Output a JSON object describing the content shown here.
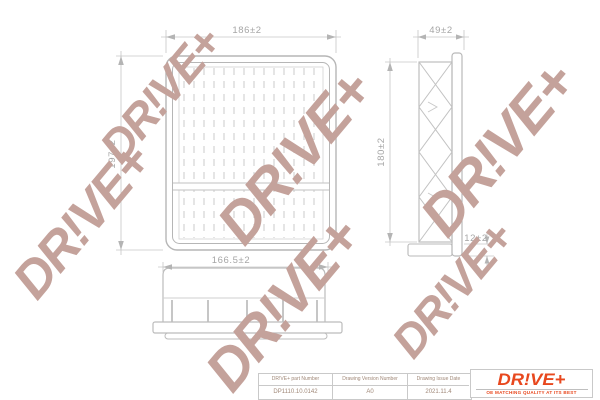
{
  "watermark": {
    "text": "DR!VE+"
  },
  "colors": {
    "accent": "#e8481e",
    "watermark": "#c4a29b",
    "drawing_line": "#b6b6b6",
    "dim_text": "#a6a6a6"
  },
  "views": {
    "top": {
      "width_dim": "186±2",
      "height_dim": "197±2"
    },
    "side": {
      "width_dim": "49±2",
      "height_dim": "180±2",
      "lip_dim": "12±2"
    },
    "front": {
      "width_dim": "166.5±2"
    }
  },
  "title_block": {
    "part_number_label": "DR!VE+ part Number",
    "part_number_value": "DP1110.10.0142",
    "version_label": "Drawing Version Number",
    "version_value": "A0",
    "date_label": "Drawing Issue Date",
    "date_value": "2021.11.4"
  },
  "logo": {
    "wordmark": "DR!VE+",
    "tagline": "OE MATCHING QUALITY AT ITS BEST"
  }
}
